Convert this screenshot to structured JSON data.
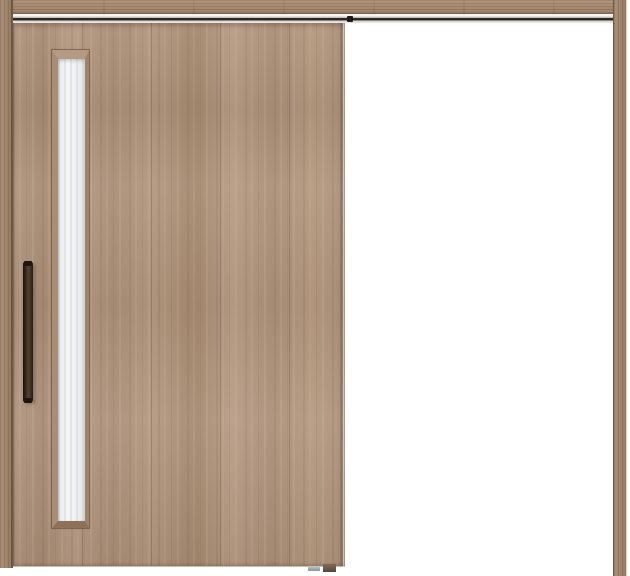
{
  "meta": {
    "title": "Sliding wood door unit shown open",
    "canvas": {
      "width": 630,
      "height": 576
    }
  },
  "scene": {
    "type": "product-image",
    "subject": "Single sliding door in light walnut wood finish, slid to the left with the open doorway (white) on the right",
    "components": {
      "head_jamb": "wood head jamb across the top",
      "hanger_rail": "metal hanger track with dark groove under the head jamb",
      "left_jamb": "vertical wood frame post on the left",
      "right_jamb": "vertical wood frame post on the right",
      "door_panel": "flat vertical-grain wood door slab",
      "glass_window": "tall narrow frosted glass slit with mitered wood frame near the handle edge",
      "handle": "vertical dark bronze pull bar",
      "track_stopper": "dark roller stop on the track at the door trailing edge",
      "floor_guide": "small floor guide parts at the door bottom trailing corner",
      "opening": "empty white doorway opening"
    }
  },
  "colors": {
    "wood_base": "#b2967f",
    "wood_dark_streak": "#8f7460",
    "wood_light_streak": "#c6ab93",
    "wood_header": "#a78c74",
    "wood_jamb": "#a2876f",
    "track_dark": "#2e241d",
    "track_silver": "#d6d6d4",
    "track_white": "#f4f4f2",
    "glass": "#eef0f1",
    "glass_shade": "#dfe3e5",
    "handle_dark": "#241b14",
    "handle_light": "#54422f",
    "guide_gray": "#a7abad",
    "guide_brown": "#6e5c4b",
    "background": "#ffffff"
  }
}
